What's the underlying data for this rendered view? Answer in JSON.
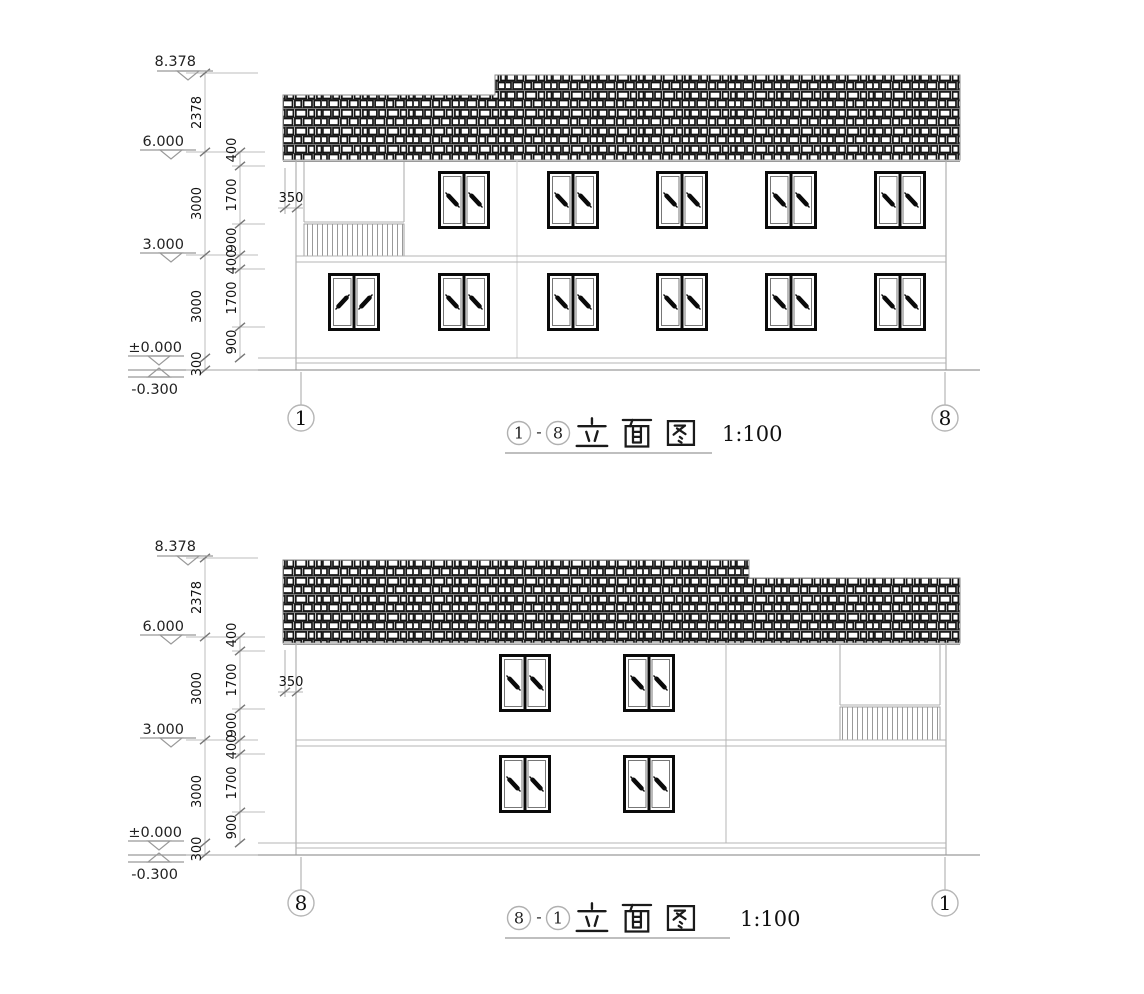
{
  "sheet": {
    "background": "#ffffff",
    "line_color_light": "#b5b5b5",
    "line_color_dim": "#999999",
    "ink": "#0a0a0a"
  },
  "elevations": [
    {
      "name": "elevation-1-8",
      "title": {
        "from": "1",
        "sep": "-",
        "to": "8",
        "text": "立面图",
        "scale": "1:100"
      },
      "grid_left": "1",
      "grid_right": "8",
      "levels": [
        "8.378",
        "6.000",
        "3.000",
        "±0.000",
        "-0.300"
      ],
      "overall_dims": [
        "2378",
        "3000",
        "3000",
        "300"
      ],
      "floor_dims": [
        "400",
        "1700",
        "900",
        "400",
        "1700",
        "900"
      ],
      "eave_overhang_dim": "350",
      "window_grid": {
        "upper_count": 5,
        "lower_count": 6
      },
      "features": [
        "tiled-roof-stepped-right-high",
        "balcony-railing-left",
        "two-story"
      ]
    },
    {
      "name": "elevation-8-1",
      "title": {
        "from": "8",
        "sep": "-",
        "to": "1",
        "text": "立面图",
        "scale": "1:100"
      },
      "grid_left": "8",
      "grid_right": "1",
      "levels": [
        "8.378",
        "6.000",
        "3.000",
        "±0.000",
        "-0.300"
      ],
      "overall_dims": [
        "2378",
        "3000",
        "3000",
        "300"
      ],
      "floor_dims": [
        "400",
        "1700",
        "900",
        "400",
        "1700",
        "900"
      ],
      "eave_overhang_dim": "350",
      "window_grid": {
        "upper_count": 2,
        "lower_count": 2
      },
      "features": [
        "tiled-roof-stepped-left-high",
        "balcony-railing-right",
        "two-story"
      ]
    }
  ]
}
